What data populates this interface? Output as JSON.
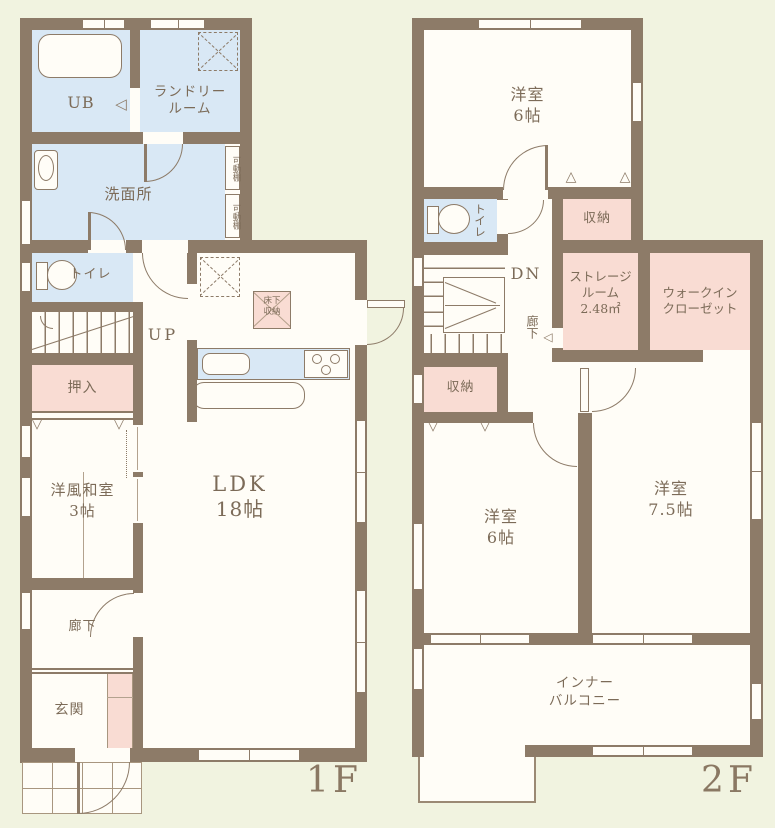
{
  "palette": {
    "background": "#f1f3e0",
    "wall": "#8d7b68",
    "room_white": "#fffdf7",
    "wet_area_blue": "#d9e8f5",
    "storage_pink": "#f9dcd3",
    "label_text": "#7c6b58",
    "floor_label_text": "#8a7863"
  },
  "floor1": {
    "floor_label": "1F",
    "up_label": "UP",
    "rooms": {
      "ub": "UB",
      "laundry_1": "ランドリー",
      "laundry_2": "ルーム",
      "washroom": "洗面所",
      "shelf_1": "可動棚",
      "shelf_2": "可動棚",
      "toilet": "トイレ",
      "oshiire": "押入",
      "washitsu_1": "洋風和室",
      "washitsu_2": "3帖",
      "ldk_1": "LDK",
      "ldk_2": "18帖",
      "underfloor_1": "床下",
      "underfloor_2": "収納",
      "hallway": "廊下",
      "entrance": "玄関"
    }
  },
  "floor2": {
    "floor_label": "2F",
    "dn_label": "DN",
    "rooms": {
      "bedroom_north_1": "洋室",
      "bedroom_north_2": "6帖",
      "toilet": "トイレ",
      "closet_north": "収納",
      "hallway": "廊下",
      "storage_room_1": "ストレージ",
      "storage_room_2": "ルーム",
      "storage_room_3": "2.48㎡",
      "wic_1": "ウォークイン",
      "wic_2": "クローゼット",
      "closet_west": "収納",
      "bedroom_sw_1": "洋室",
      "bedroom_sw_2": "6帖",
      "bedroom_se_1": "洋室",
      "bedroom_se_2": "7.5帖",
      "balcony_1": "インナー",
      "balcony_2": "バルコニー"
    }
  }
}
